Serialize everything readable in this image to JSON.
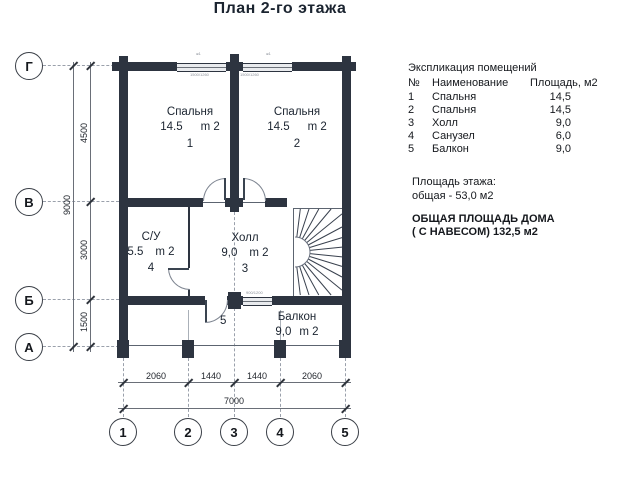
{
  "title": "План 2-го этажа",
  "legend": {
    "title": "Экспликация помещений",
    "columns": {
      "num": "№",
      "name": "Наименование",
      "area": "Площадь, м2"
    },
    "rows": [
      {
        "num": "1",
        "name": "Спальня",
        "area": "14,5"
      },
      {
        "num": "2",
        "name": "Спальня",
        "area": "14,5"
      },
      {
        "num": "3",
        "name": "Холл",
        "area": "9,0"
      },
      {
        "num": "4",
        "name": "Санузел",
        "area": "6,0"
      },
      {
        "num": "5",
        "name": "Балкон",
        "area": "9,0"
      }
    ],
    "floor_area_label": "Площадь этажа:",
    "floor_area_value": "общая - 53,0 м2",
    "total_label": "ОБЩАЯ ПЛОЩАДЬ ДОМА",
    "total_value": "( С НАВЕСОМ)   132,5 м2"
  },
  "rooms": {
    "bedroom1": {
      "name": "Спальня",
      "area": "14.5",
      "unit": "m 2",
      "num": "1"
    },
    "bedroom2": {
      "name": "Спальня",
      "area": "14.5",
      "unit": "m 2",
      "num": "2"
    },
    "bathroom": {
      "name": "С/У",
      "area": "5.5",
      "unit": "m 2",
      "num": "4"
    },
    "hall": {
      "name": "Холл",
      "area": "9,0",
      "unit": "m 2",
      "num": "3"
    },
    "balcony": {
      "name": "Балкон",
      "area": "9,0",
      "unit": "m 2",
      "num": "5"
    }
  },
  "axes": {
    "rows": [
      "Г",
      "В",
      "Б",
      "А"
    ],
    "cols": [
      "1",
      "2",
      "3",
      "4",
      "5"
    ]
  },
  "dimensions": {
    "left_inner": [
      "4500",
      "3000",
      "1500"
    ],
    "left_outer": "9000",
    "bottom_inner": [
      "2060",
      "1440",
      "1440",
      "2060"
    ],
    "bottom_outer": "7000"
  },
  "marks": {
    "window_label": "1500/1260",
    "door_label": "900/1200",
    "unit_mark": "ж1"
  },
  "colors": {
    "wall": "#2d3440",
    "background": "#ffffff"
  }
}
